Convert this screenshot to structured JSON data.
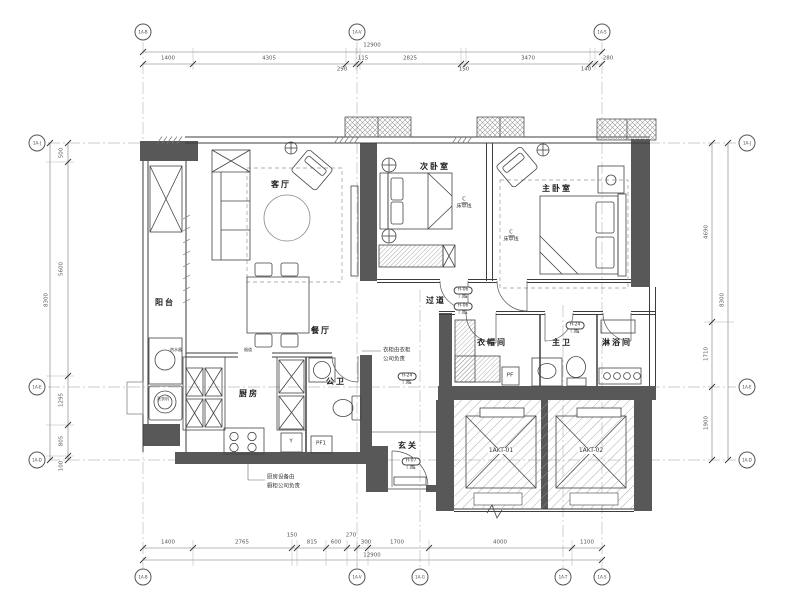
{
  "plan": {
    "rooms": {
      "living": "客厅",
      "bedroom2": "次卧室",
      "master": "主卧室",
      "balcony": "阳台",
      "dining": "餐厅",
      "kitchen": "厨房",
      "guest_bath": "公卫",
      "corridor": "过道",
      "cloakroom": "衣帽间",
      "master_bath": "主卫",
      "shower": "淋浴间",
      "foyer": "玄关"
    },
    "annotations": {
      "centerline_symbol": "C",
      "bed_centerline": "床中线",
      "threshold": "门槛",
      "tag_h06": "H-06",
      "tag_h07": "H-07",
      "tag_h24": "H-24",
      "note_wardrobe_line1": "衣柜由衣柜",
      "note_wardrobe_line2": "公司负责",
      "note_kitchen_line1": "厨房设备由",
      "note_kitchen_line2": "橱柜公司负责",
      "flue": "烟道",
      "water_heater": "热水器",
      "washer": "洗衣机",
      "shaft_pf": "PF",
      "shaft_pf1": "PF1",
      "shaft_y": "Y",
      "elevator1": "1AKT-01",
      "elevator2": "1AKT-02"
    },
    "dimensions": {
      "top_total": "12900",
      "top": [
        "1400",
        "4305",
        "290",
        "115",
        "2825",
        "150",
        "3470",
        "140",
        "280"
      ],
      "bottom": [
        "1400",
        "2765",
        "150",
        "815",
        "600",
        "270",
        "300",
        "1700",
        "4000",
        "1100"
      ],
      "bottom_total": "12900",
      "left": [
        "500",
        "5600",
        "1295",
        "805",
        "100"
      ],
      "left_total": "8300",
      "right": [
        "4690",
        "1710",
        "1900"
      ],
      "right_total": "8300"
    },
    "grid_bubbles": {
      "top": [
        "1A-B",
        "1A-V",
        "1A-S"
      ],
      "bottom": [
        "1A-B",
        "1A-V",
        "1A-G",
        "1A-T",
        "1A-S"
      ],
      "left": [
        "1A-J",
        "1A-E",
        "1A-D"
      ],
      "right": [
        "1A-J",
        "1A-E",
        "1A-D"
      ]
    }
  }
}
